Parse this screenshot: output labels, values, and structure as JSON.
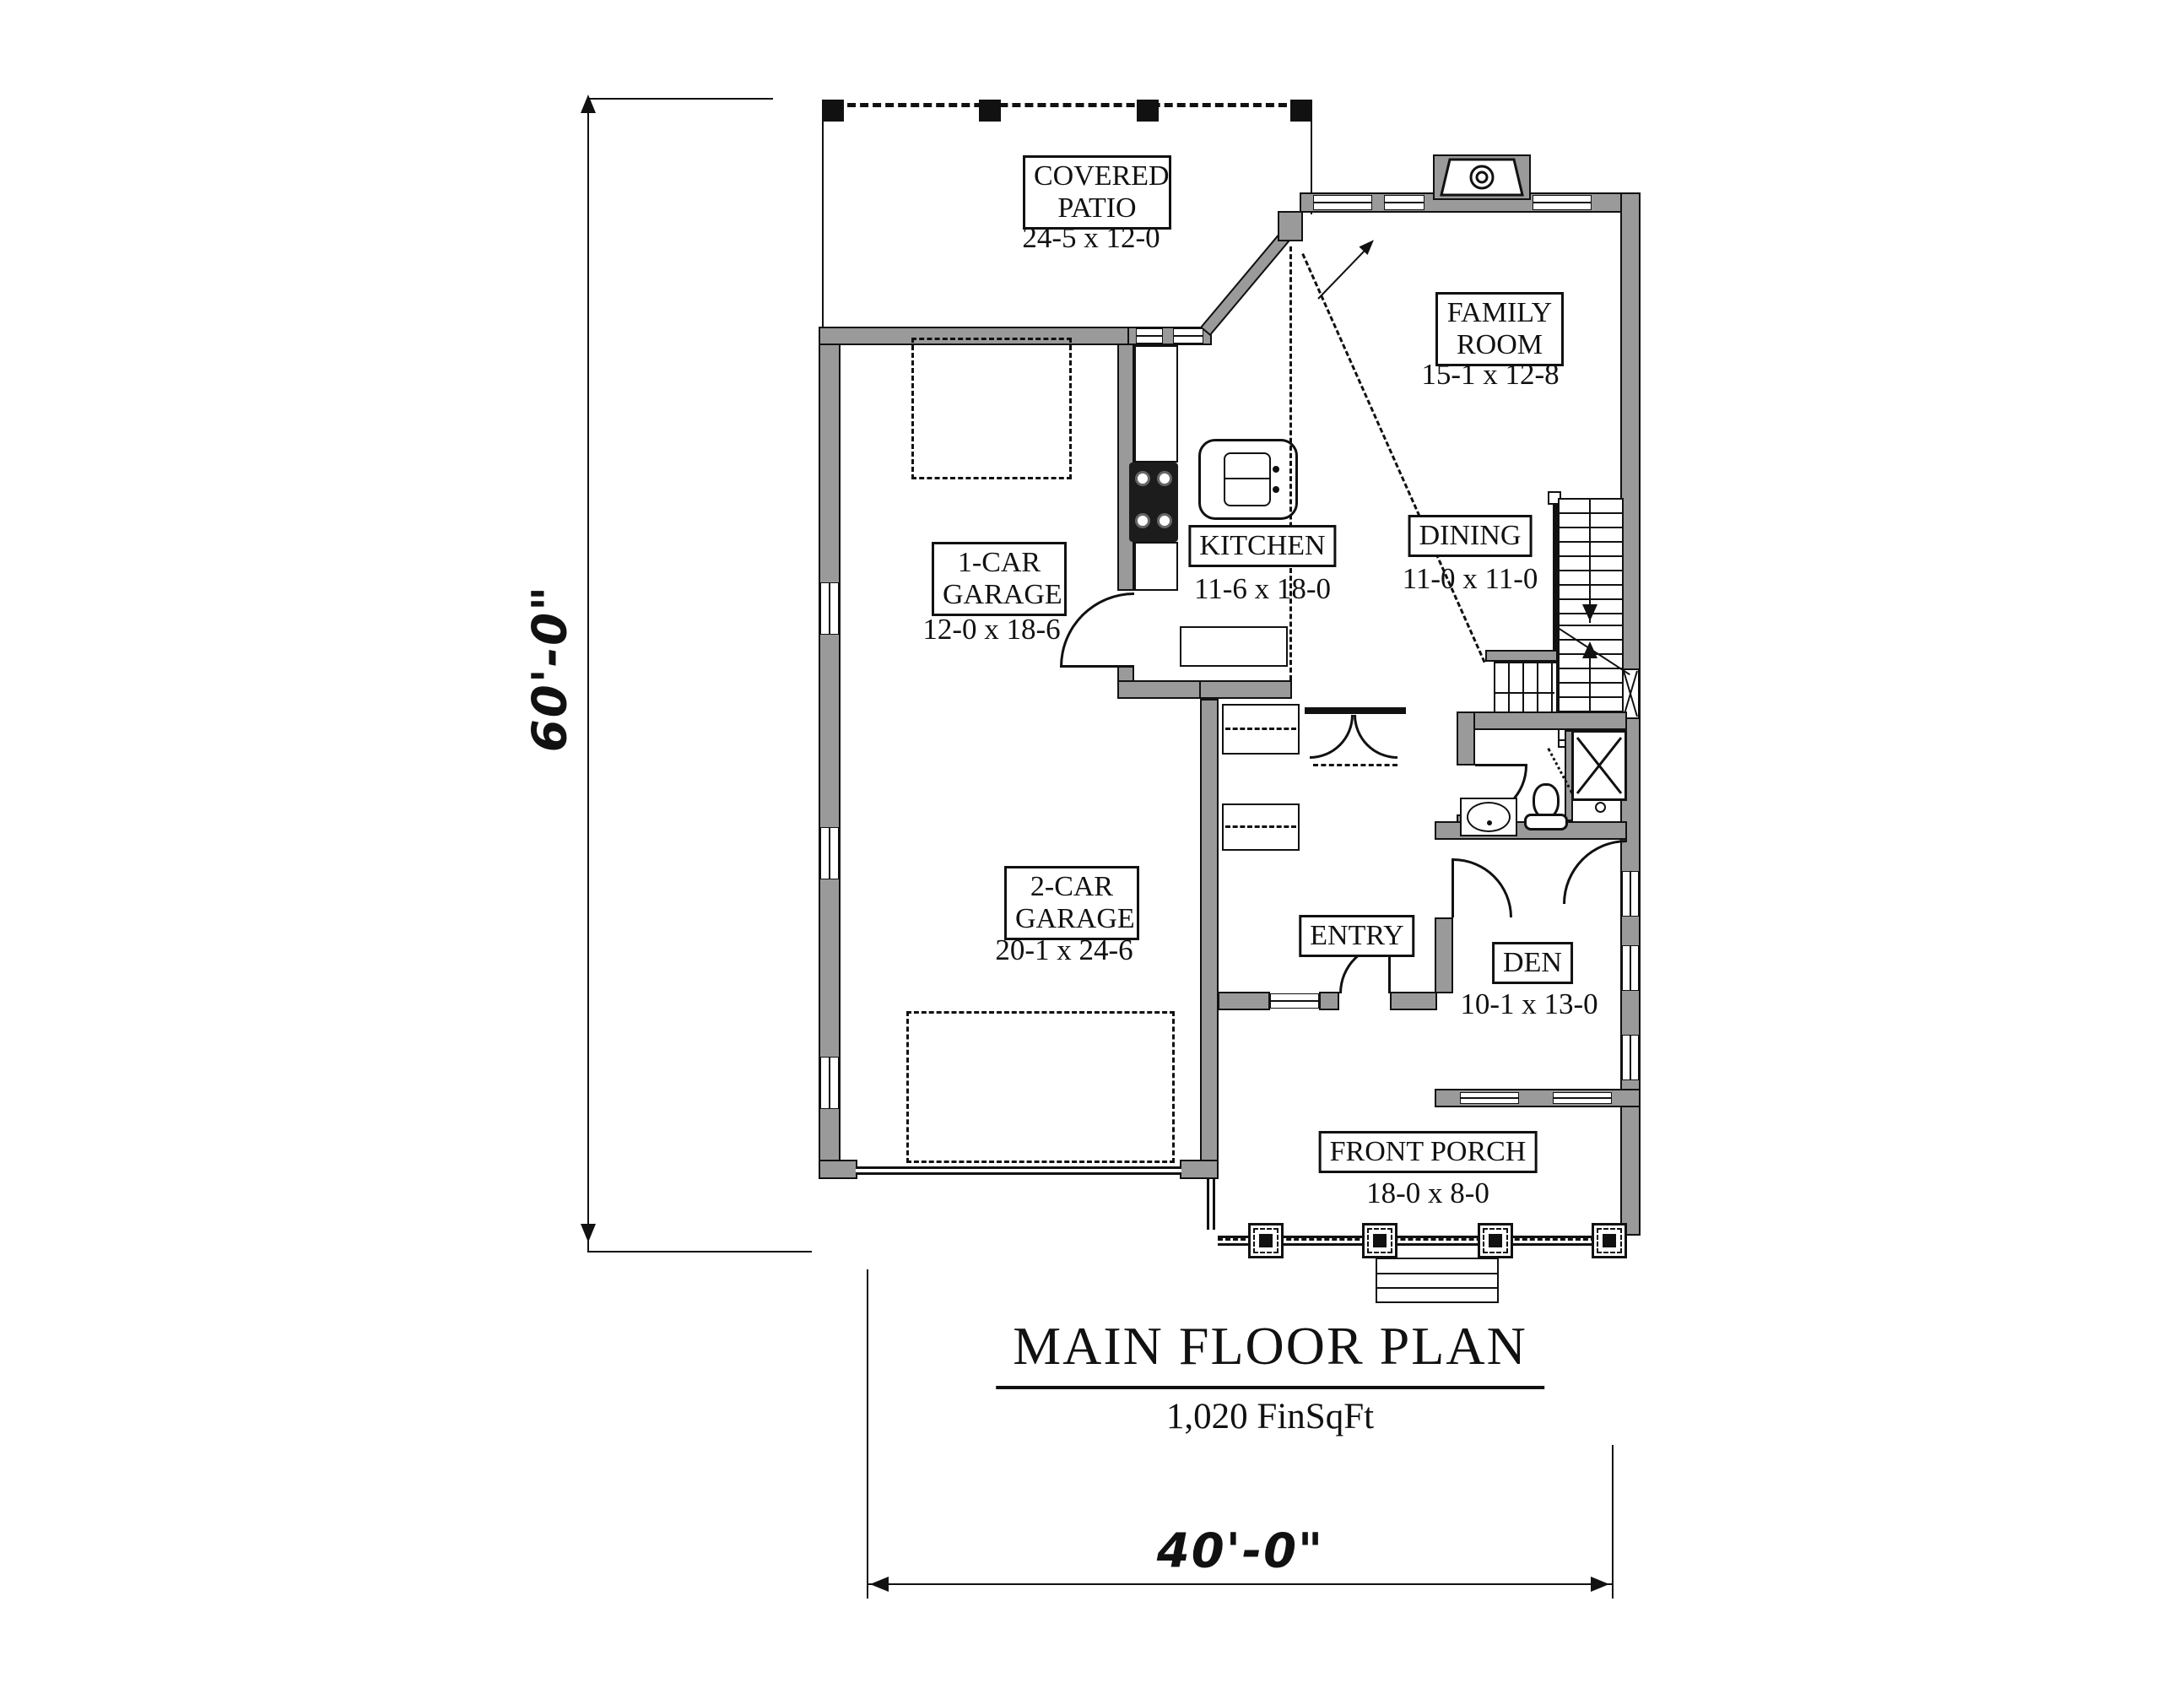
{
  "page": {
    "title": "MAIN FLOOR PLAN",
    "area": "1,020 FinSqFt"
  },
  "dimensions": {
    "overall_height": "60'-0\"",
    "overall_width": "40'-0\""
  },
  "rooms": {
    "covered_patio": {
      "name": "COVERED\nPATIO",
      "size": "24-5 x 12-0"
    },
    "family_room": {
      "name": "FAMILY\nROOM",
      "size": "15-1 x 12-8"
    },
    "kitchen": {
      "name": "KITCHEN",
      "size": "11-6 x 18-0"
    },
    "dining": {
      "name": "DINING",
      "size": "11-0 x 11-0"
    },
    "one_car_garage": {
      "name": "1-CAR\nGARAGE",
      "size": "12-0 x 18-6"
    },
    "two_car_garage": {
      "name": "2-CAR\nGARAGE",
      "size": "20-1 x 24-6"
    },
    "entry": {
      "name": "ENTRY"
    },
    "den": {
      "name": "DEN",
      "size": "10-1 x 13-0"
    },
    "front_porch": {
      "name": "FRONT PORCH",
      "size": "18-0 x 8-0"
    }
  },
  "colors": {
    "wall_fill": "#9a9a9a",
    "line": "#111111",
    "background": "#ffffff"
  }
}
